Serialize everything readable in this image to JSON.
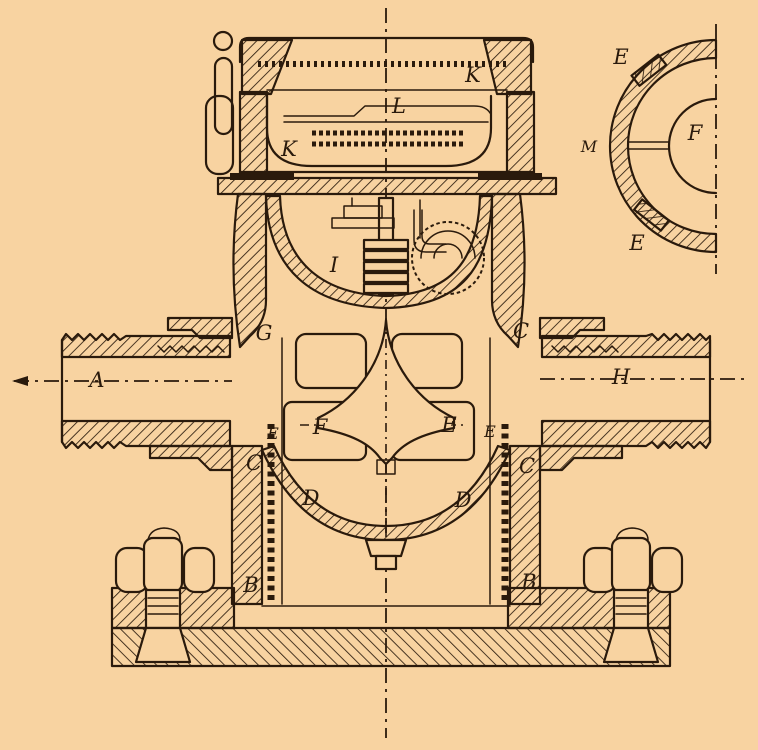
{
  "colors": {
    "paper": "#f8d3a1",
    "ink": "#2a1a0c"
  },
  "labels": {
    "main": [
      {
        "text": "K",
        "x": 473,
        "y": 82
      },
      {
        "text": "L",
        "x": 399,
        "y": 113
      },
      {
        "text": "K",
        "x": 289,
        "y": 156
      },
      {
        "text": "I",
        "x": 334,
        "y": 272
      },
      {
        "text": "G",
        "x": 264,
        "y": 340
      },
      {
        "text": "C",
        "x": 521,
        "y": 338
      },
      {
        "text": "A",
        "x": 97,
        "y": 387
      },
      {
        "text": "H",
        "x": 621,
        "y": 384
      },
      {
        "text": "E",
        "x": 273,
        "y": 439
      },
      {
        "text": "F",
        "x": 320,
        "y": 434
      },
      {
        "text": "E",
        "x": 449,
        "y": 432
      },
      {
        "text": "E",
        "x": 490,
        "y": 437
      },
      {
        "text": "C",
        "x": 254,
        "y": 470
      },
      {
        "text": "C",
        "x": 527,
        "y": 473
      },
      {
        "text": "D",
        "x": 311,
        "y": 505
      },
      {
        "text": "D",
        "x": 463,
        "y": 507
      },
      {
        "text": "B",
        "x": 251,
        "y": 592
      },
      {
        "text": "B",
        "x": 529,
        "y": 589
      }
    ],
    "detail": [
      {
        "text": "E",
        "x": 621,
        "y": 64
      },
      {
        "text": "M",
        "x": 589,
        "y": 152
      },
      {
        "text": "F",
        "x": 695,
        "y": 140
      },
      {
        "text": "E",
        "x": 637,
        "y": 250
      }
    ]
  }
}
